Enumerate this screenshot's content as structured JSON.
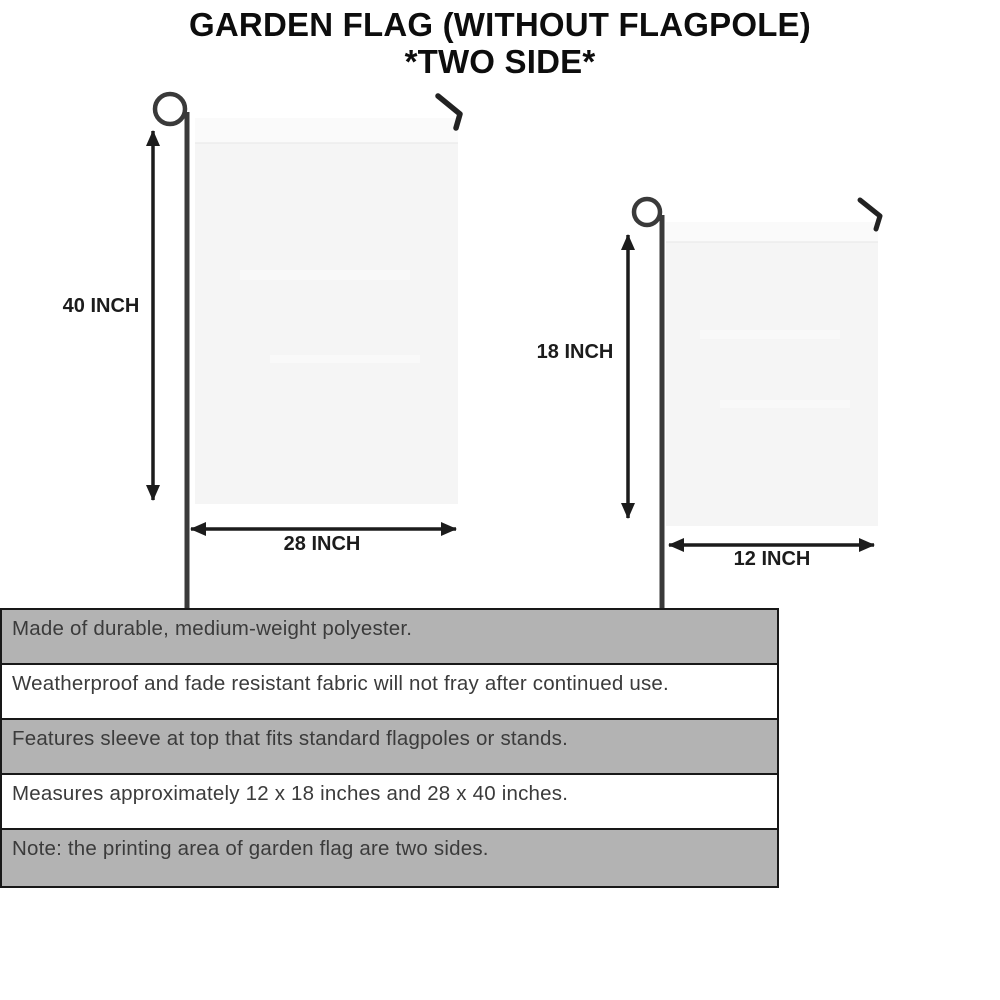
{
  "title": {
    "line1": "GARDEN FLAG (WITHOUT FLAGPOLE)",
    "line2": "*TWO SIDE*"
  },
  "diagram": {
    "large_flag": {
      "height_label": "40 INCH",
      "width_label": "28 INCH"
    },
    "small_flag": {
      "height_label": "18 INCH",
      "width_label": "12 INCH"
    }
  },
  "features": {
    "rows": [
      {
        "text": "Made of durable, medium-weight polyester."
      },
      {
        "text": "Weatherproof and fade resistant fabric will not fray after continued use."
      },
      {
        "text": "Features sleeve at top that fits standard flagpoles or stands."
      },
      {
        "text": "Measures approximately 12 x 18 inches and 28 x 40 inches."
      },
      {
        "text": "Note: the printing area of garden flag are two sides."
      }
    ]
  },
  "colors": {
    "row_gray": "#b3b3b3",
    "row_white": "#ffffff",
    "table_border": "#181818",
    "flag_fill": "#f5f5f5",
    "flag_sleeve": "#fafafa",
    "pole": "#3a3a3a",
    "arrow": "#1c1c1c",
    "title_text": "#0d0d0d",
    "body_text": "#3b3b3b"
  }
}
